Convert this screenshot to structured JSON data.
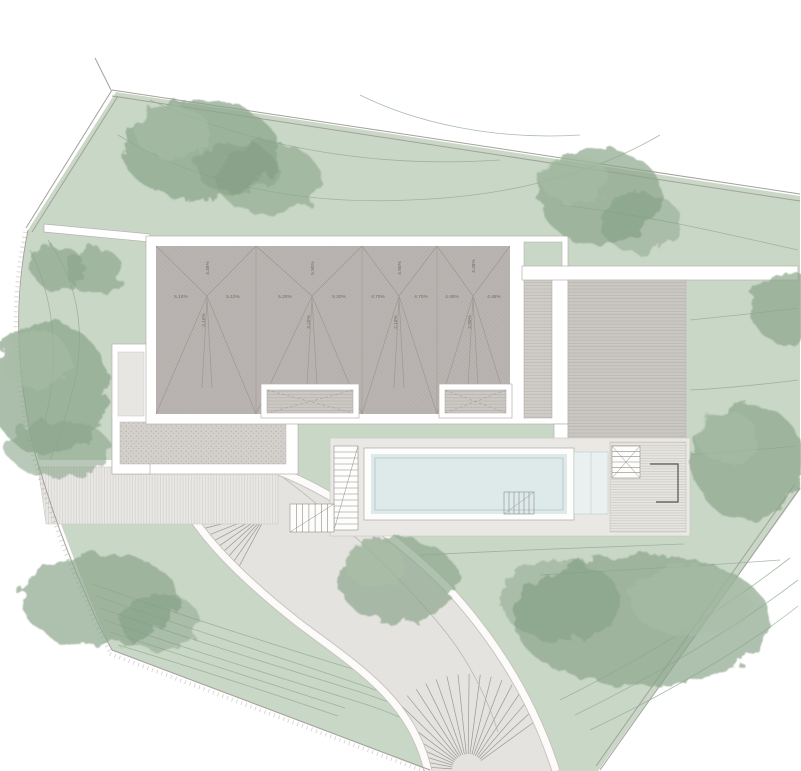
{
  "plan": {
    "roof": {
      "panels": [
        {
          "left": "5.10%",
          "right": "5.10%",
          "top": "4.48%",
          "bottom": "2.10%"
        },
        {
          "left": "5.20%",
          "right": "5.20%",
          "top": "5.90%",
          "bottom": "3.20%"
        },
        {
          "left": "4.70%",
          "right": "4.70%",
          "top": "4.90%",
          "bottom": "2.10%"
        },
        {
          "left": "4.48%",
          "right": "4.48%",
          "top": "4.48%",
          "bottom": "2.90%"
        }
      ]
    },
    "palette": {
      "lawn": "#c9d7c6",
      "roof": "#b9b4b1",
      "water": "#dee9ea",
      "paving": "#e9e8e5",
      "terrace": "#cbc7c3",
      "gravel": "#d3d0cc",
      "driveway": "#e4e3e0",
      "tree": "#8ba58b",
      "wall": "#ffffff",
      "line": "#a5a09b"
    }
  }
}
